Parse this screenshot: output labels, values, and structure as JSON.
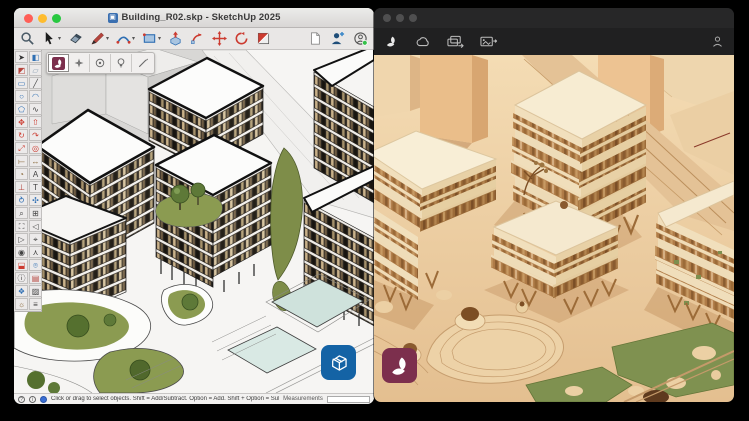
{
  "left_window": {
    "title": "Building_R02.skp - SketchUp 2025",
    "traffic_lights": [
      "#ff5f57",
      "#febc2e",
      "#28c840"
    ],
    "toolbar_main": [
      "zoom",
      "select",
      "eraser",
      "line",
      "arc",
      "shapes",
      "push-pull",
      "follow-me",
      "move",
      "rotate",
      "section-plane",
      "new-document",
      "add-location",
      "account"
    ],
    "toolbar_plugin": [
      "render-plugin-logo",
      "enhance",
      "target",
      "idea",
      "draw"
    ],
    "tool_palette": [
      {
        "name": "select",
        "glyph": "➤",
        "color": "#333333"
      },
      {
        "name": "make-component",
        "glyph": "◧",
        "color": "#2f6fb3"
      },
      {
        "name": "paint-bucket",
        "glyph": "◩",
        "color": "#b5443c"
      },
      {
        "name": "eraser",
        "glyph": "▱",
        "color": "#8fa3b5"
      },
      {
        "name": "rectangle",
        "glyph": "▭",
        "color": "#2f6fb3"
      },
      {
        "name": "line",
        "glyph": "╱",
        "color": "#444444"
      },
      {
        "name": "circle",
        "glyph": "○",
        "color": "#2f6fb3"
      },
      {
        "name": "arc",
        "glyph": "◠",
        "color": "#2f6fb3"
      },
      {
        "name": "polygon",
        "glyph": "⬠",
        "color": "#2f6fb3"
      },
      {
        "name": "freehand",
        "glyph": "∿",
        "color": "#444444"
      },
      {
        "name": "move",
        "glyph": "✥",
        "color": "#cc3b30"
      },
      {
        "name": "push-pull",
        "glyph": "⇧",
        "color": "#cc3b30"
      },
      {
        "name": "rotate",
        "glyph": "↻",
        "color": "#cc3b30"
      },
      {
        "name": "follow-me",
        "glyph": "↷",
        "color": "#cc3b30"
      },
      {
        "name": "scale",
        "glyph": "⤢",
        "color": "#cc3b30"
      },
      {
        "name": "offset",
        "glyph": "◎",
        "color": "#cc3b30"
      },
      {
        "name": "tape-measure",
        "glyph": "⟝",
        "color": "#8a6a3a"
      },
      {
        "name": "dimension",
        "glyph": "↔",
        "color": "#8a6a3a"
      },
      {
        "name": "protractor",
        "glyph": "◔",
        "color": "#8a6a3a"
      },
      {
        "name": "text",
        "glyph": "A",
        "color": "#444444"
      },
      {
        "name": "axes",
        "glyph": "⊥",
        "color": "#b5443c"
      },
      {
        "name": "3d-text",
        "glyph": "T",
        "color": "#444444"
      },
      {
        "name": "orbit",
        "glyph": "⥁",
        "color": "#2f6fb3"
      },
      {
        "name": "pan",
        "glyph": "✣",
        "color": "#2f6fb3"
      },
      {
        "name": "zoom",
        "glyph": "⌕",
        "color": "#444444"
      },
      {
        "name": "zoom-window",
        "glyph": "⊞",
        "color": "#444444"
      },
      {
        "name": "zoom-extents",
        "glyph": "⛶",
        "color": "#444444"
      },
      {
        "name": "previous",
        "glyph": "◁",
        "color": "#444444"
      },
      {
        "name": "next",
        "glyph": "▷",
        "color": "#444444"
      },
      {
        "name": "position-camera",
        "glyph": "⌖",
        "color": "#444444"
      },
      {
        "name": "look-around",
        "glyph": "◉",
        "color": "#444444"
      },
      {
        "name": "walk",
        "glyph": "⋏",
        "color": "#444444"
      },
      {
        "name": "section-plane",
        "glyph": "⬓",
        "color": "#cc3b30"
      },
      {
        "name": "add-location",
        "glyph": "⌾",
        "color": "#2f6fb3"
      },
      {
        "name": "model-info",
        "glyph": "ⓘ",
        "color": "#444444"
      },
      {
        "name": "materials",
        "glyph": "▤",
        "color": "#b5443c"
      },
      {
        "name": "components",
        "glyph": "❖",
        "color": "#2f6fb3"
      },
      {
        "name": "styles",
        "glyph": "▨",
        "color": "#444444"
      },
      {
        "name": "shadows",
        "glyph": "☼",
        "color": "#8a6a3a"
      },
      {
        "name": "tags",
        "glyph": "≡",
        "color": "#444444"
      }
    ],
    "status_bar": {
      "hint": "Click or drag to select objects. Shift = Add/Subtract. Option = Add. Shift + Option = Subtract.",
      "measurements_label": "Measurements",
      "measurements_value": ""
    },
    "badge_color": "#1463a5"
  },
  "right_window": {
    "toolbar": [
      "app-logo",
      "cloud-render",
      "render-gallery",
      "export-image",
      "account"
    ],
    "badge_color": "#7c2f4d"
  },
  "colors": {
    "desktop_background": "#000000",
    "accent_maroon": "#7c2f4d",
    "sketchup_blue": "#1463a5",
    "render_scene_beige": "#e9c9a0",
    "model_green": "#7f9150"
  }
}
